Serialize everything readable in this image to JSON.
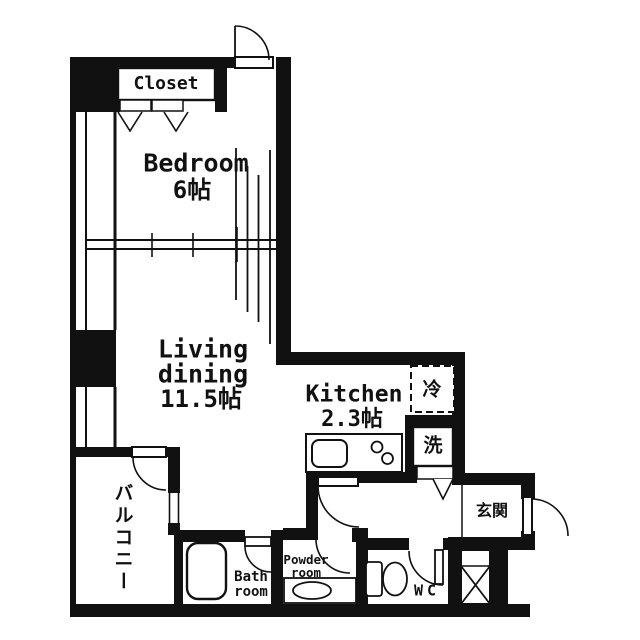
{
  "floorplan": {
    "colors": {
      "ink": "#111111",
      "background": "#ffffff"
    },
    "rooms": {
      "closet": {
        "label": "Closet"
      },
      "bedroom": {
        "label": "Bedroom",
        "size": "6帖"
      },
      "living": {
        "label_line1": "Living",
        "label_line2": "dining",
        "size": "11.5帖"
      },
      "kitchen": {
        "label": "Kitchen",
        "size": "2.3帖"
      },
      "balcony": {
        "label": "バルコニー"
      },
      "bath": {
        "label_line1": "Bath",
        "label_line2": "room"
      },
      "powder": {
        "label_line1": "Powder",
        "label_line2": "room"
      },
      "wc": {
        "label": "WC"
      },
      "entrance": {
        "label": "玄関"
      }
    },
    "fixtures": {
      "refrigerator": {
        "label": "冷"
      },
      "washer": {
        "label": "洗"
      }
    }
  }
}
